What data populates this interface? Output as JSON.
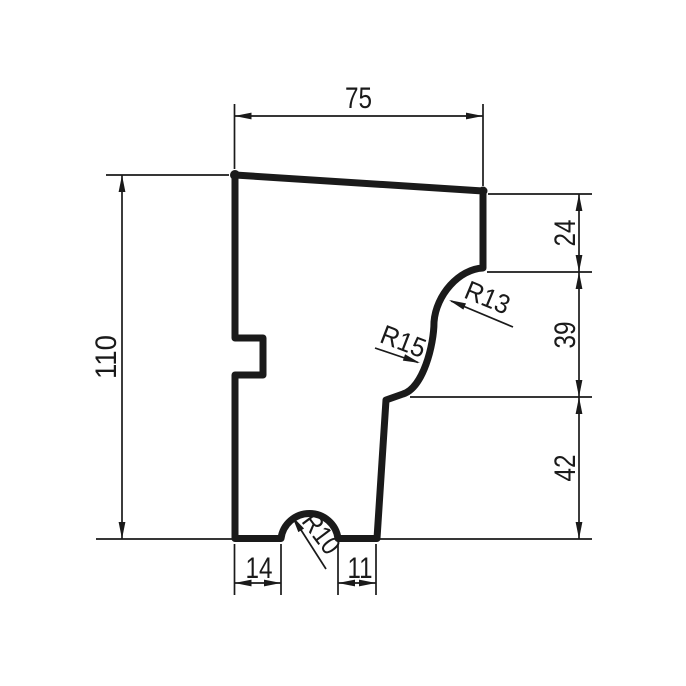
{
  "drawing": {
    "type": "technical-profile-drawing",
    "dimensions": {
      "top_width": "75",
      "total_height": "110",
      "right_top": "24",
      "right_middle": "39",
      "right_bottom": "42",
      "bottom_left": "14",
      "bottom_right": "11"
    },
    "radius_labels": {
      "upper_cove": "R13",
      "middle_ogee": "R15",
      "bottom_bump": "R10"
    },
    "colors": {
      "line": "#1a1a1a",
      "background": "#ffffff"
    }
  }
}
